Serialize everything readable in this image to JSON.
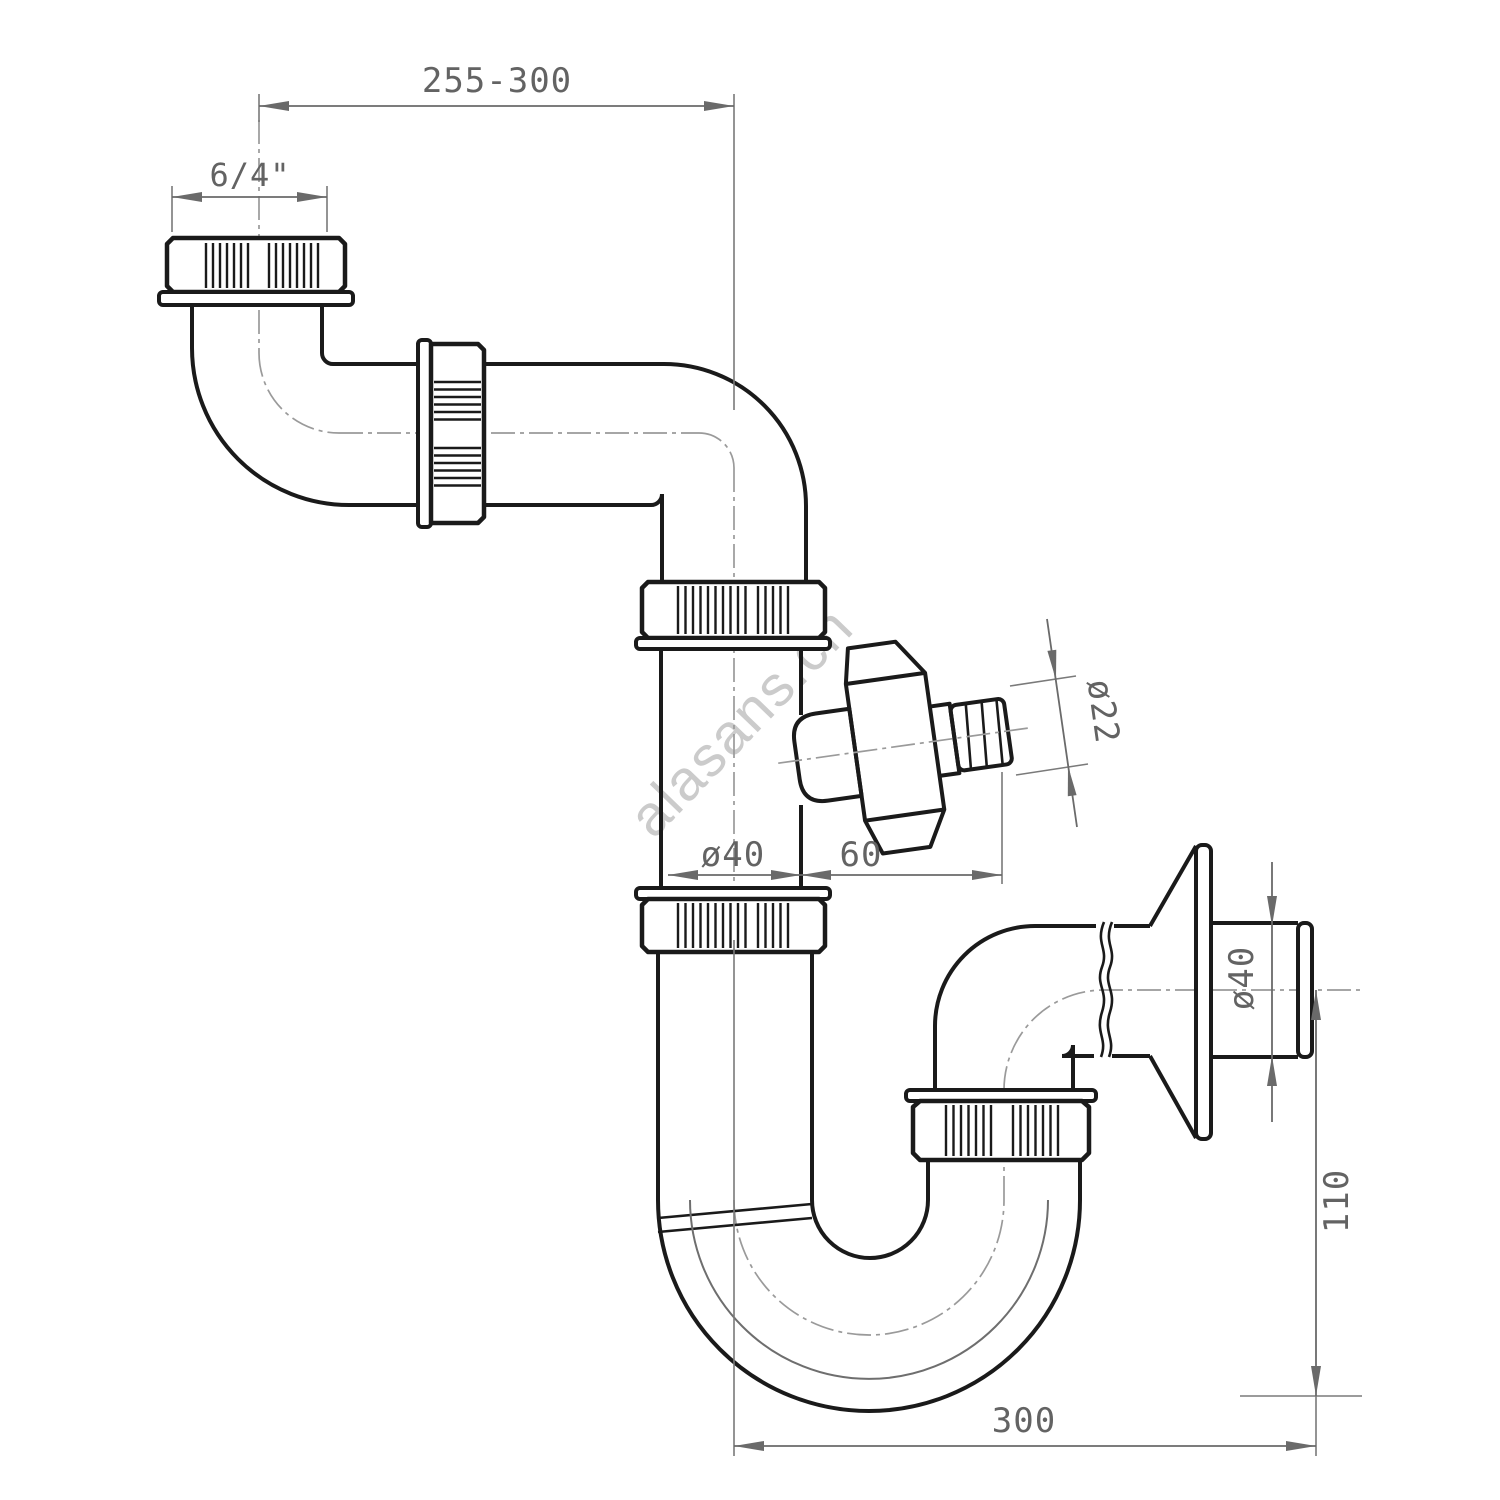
{
  "drawing": {
    "watermark": "alasans.ch",
    "dimensions": {
      "overall_width": "255-300",
      "inlet_thread": "6/4\"",
      "pipe_diameter": "ø40",
      "branch_offset": "60",
      "branch_diameter": "ø22",
      "outlet_diameter": "ø40",
      "outlet_height": "110",
      "trap_span": "300"
    },
    "colors": {
      "outline": "#1a1a1a",
      "dimension_lines": "#6a6a6a",
      "centerline": "#9a9a9a",
      "watermark": "#c2c2c2",
      "background": "#ffffff"
    }
  }
}
